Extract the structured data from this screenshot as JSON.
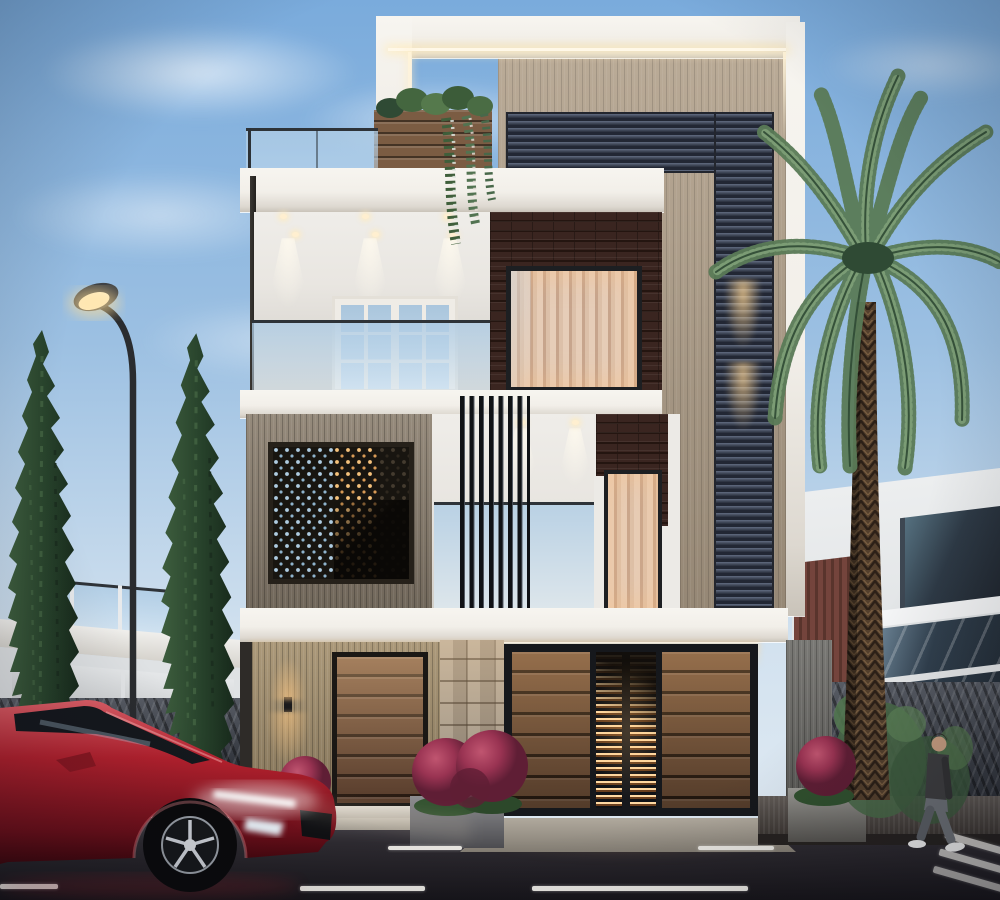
{
  "scene": {
    "type": "architectural-exterior-3d-render",
    "time_of_day": "dusk",
    "description": "Modern three-storey residence street view with warm accent lighting",
    "objects": [
      "three-storey modern house",
      "rooftop glass railing",
      "rooftop planter with hanging vines",
      "led cove lighting",
      "slatted louver feature column",
      "brick feature walls",
      "perforated jali screen",
      "vertical louver fins",
      "balcony with french doors",
      "curtained picture windows",
      "timber entrance door",
      "stacked stone pillar",
      "timber-and-louver main gate with lit staircase behind",
      "street lamp",
      "two italian cypress trees",
      "date palm tree",
      "left neighbour villa",
      "right neighbour building",
      "stone boundary walls with ivy",
      "red sports sedan with lit drl",
      "walking man",
      "magenta flower planters",
      "asphalt road with lane markings",
      "driveway ramp",
      "sidewalk"
    ]
  },
  "colors": {
    "sky_top": "#7aabdc",
    "sky_horizon": "#d3e2ef",
    "fascia": "#f2efe9",
    "tan_panel": "#b2a18b",
    "louver_face": "#3d4555",
    "louver_dark": "#222734",
    "louver_light": "#5a6478",
    "brick": "#3a2520",
    "brick_mortar": "#241510",
    "marble": "#e9e6e1",
    "glass": "#bcd6ea",
    "curtain": "#e6cdb8",
    "curtain_dark": "#c7a58d",
    "wood_wall": "#8d8171",
    "jali_bg": "#181510",
    "jali_dot_cool": "#aecbe0",
    "jali_dot_warm": "#f5c27c",
    "planter_wood": "#7b5c43",
    "door_wood": "#74503a",
    "stone_light": "#b2a798",
    "gate_wood": "#77553c",
    "gate_frame": "#16181c",
    "glow": "#ffd9a2",
    "glow_strong": "#ffc473",
    "road": "#2e2b31",
    "road_dark": "#17151a",
    "lane": "#e8e6e1",
    "car_red": "#b5212e",
    "car_red_dark": "#6e0f1a",
    "car_red_light": "#df5f68",
    "cypress": "#27422b",
    "cypress_light": "#3e5e3e",
    "palm": "#5a7b57",
    "palm_dark": "#2f4a34",
    "palm_light": "#7fa078",
    "trunk": "#54402d",
    "trunk_dark": "#2c2017",
    "flower": "#993352",
    "flower_dark": "#5f1e35",
    "flower_light": "#c05570",
    "ivy": "#486847",
    "wall_rock": "#3c414b",
    "neighbor_white": "#dfe2e4",
    "neighbor_window": "#2e3a46",
    "maroon_slat": "#74443c",
    "skin": "#c99f82",
    "sweater": "#3e3e40",
    "jeans": "#6d7177",
    "shoe": "#f2f2f2",
    "lamp_metal": "#2a2c2f"
  }
}
